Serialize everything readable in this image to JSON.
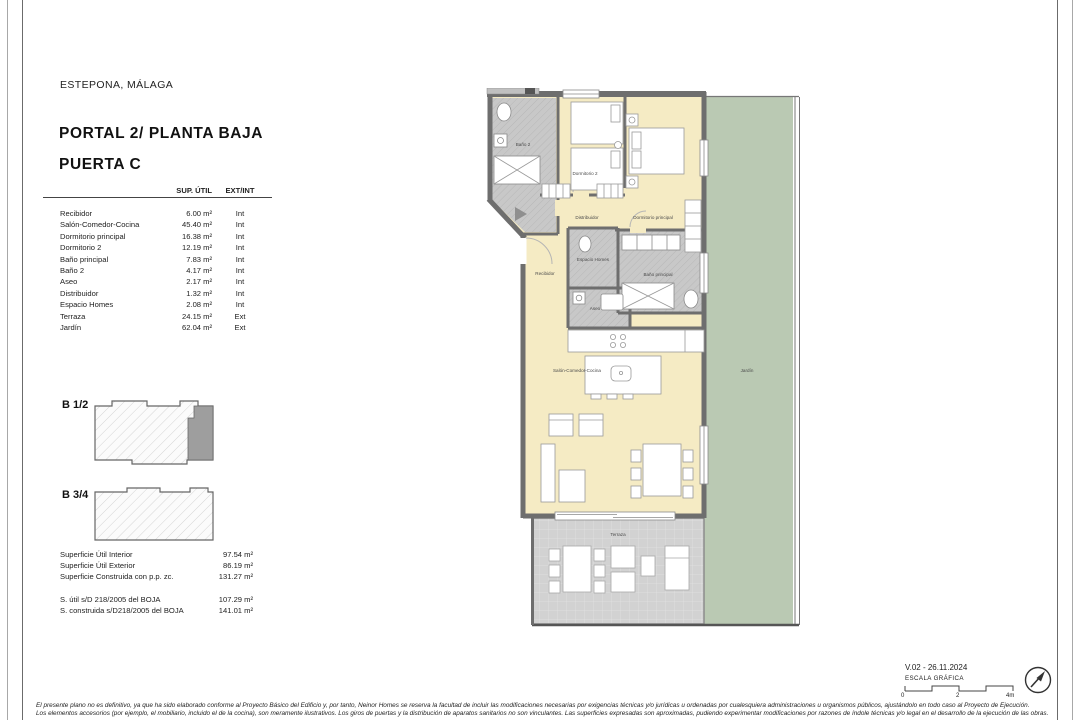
{
  "header": {
    "location": "ESTEPONA, MÁLAGA",
    "title_line1": "PORTAL 2/ PLANTA BAJA",
    "title_line2": "PUERTA C"
  },
  "table": {
    "headers": {
      "area": "SUP. ÚTIL",
      "type": "EXT/INT"
    },
    "rows": [
      {
        "name": "Recibidor",
        "area": "6.00 m²",
        "type": "Int"
      },
      {
        "name": "Salón-Comedor-Cocina",
        "area": "45.40 m²",
        "type": "Int"
      },
      {
        "name": "Dormitorio principal",
        "area": "16.38 m²",
        "type": "Int"
      },
      {
        "name": "Dormitorio 2",
        "area": "12.19 m²",
        "type": "Int"
      },
      {
        "name": "Baño principal",
        "area": "7.83 m²",
        "type": "Int"
      },
      {
        "name": "Baño 2",
        "area": "4.17 m²",
        "type": "Int"
      },
      {
        "name": "Aseo",
        "area": "2.17 m²",
        "type": "Int"
      },
      {
        "name": "Distribuidor",
        "area": "1.32 m²",
        "type": "Int"
      },
      {
        "name": "Espacio Homes",
        "area": "2.08 m²",
        "type": "Int"
      },
      {
        "name": "Terraza",
        "area": "24.15 m²",
        "type": "Ext"
      },
      {
        "name": "Jardín",
        "area": "62.04 m²",
        "type": "Ext"
      }
    ]
  },
  "key_plans": [
    {
      "label": "B 1/2"
    },
    {
      "label": "B 3/4"
    }
  ],
  "summary": {
    "rows": [
      {
        "label": "Superficie Útil Interior",
        "value": "97.54 m²"
      },
      {
        "label": "Superficie Útil Exterior",
        "value": "86.19 m²"
      },
      {
        "label": "Superficie Construida con p.p. zc.",
        "value": "131.27 m²"
      }
    ],
    "boja_rows": [
      {
        "label": "S. útil s/D 218/2005 del BOJA",
        "value": "107.29 m²"
      },
      {
        "label": "S. construida s/D218/2005 del BOJA",
        "value": "141.01 m²"
      }
    ]
  },
  "plan": {
    "labels": {
      "bano2": "Baño 2",
      "dormitorio2": "Dormitorio 2",
      "distribuidor": "Distribuidor",
      "dormitorio_principal": "Dormitorio principal",
      "espacio_homes": "Espacio Homes",
      "recibidor": "Recibidor",
      "bano_principal": "Baño principal",
      "aseo": "Aseo",
      "salon": "Salón-Comedor-Cocina",
      "jardin": "Jardín",
      "terraza": "Terraza"
    },
    "watermark": "nb-toro.co"
  },
  "footer": {
    "version": "V.02 - 26.11.2024",
    "scale_label": "ESCALA GRÁFICA",
    "scale_ticks": [
      "0",
      "2",
      "4m"
    ],
    "disclaimer_line1": "El presente plano no es definitivo, ya que ha sido elaborado conforme al Proyecto Básico del Edificio y, por tanto, Neinor Homes se reserva la facultad de incluir las modificaciones necesarias por exigencias técnicas y/o jurídicas u ordenadas por cualesquiera administraciones u organismos públicos, ajustándolo en todo caso al Proyecto de Ejecución.",
    "disclaimer_line2": "Los elementos accesorios (por ejemplo, el mobiliario, incluido el de la cocina), son meramente ilustrativos. Los giros de puertas y la distribución de aparatos sanitarios no son vinculantes. Las superficies expresadas son aproximadas, pudiendo experimentar modificaciones por razones de índole técnicas y/o legal en el desarrollo de la ejecución de las obras."
  },
  "colors": {
    "room": "#f5ebc4",
    "wet": "#c8c8c8",
    "garden": "#bac9b3",
    "terrace": "#d2d2d2",
    "wall": "#6e6e6e",
    "highlight": "#9e9e9e"
  }
}
